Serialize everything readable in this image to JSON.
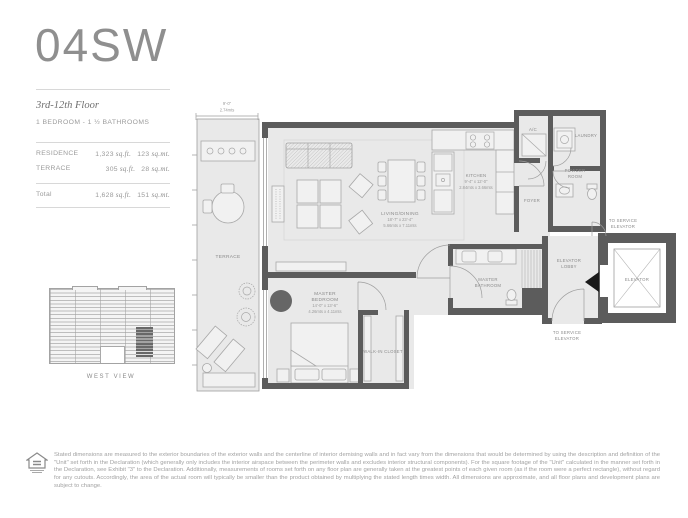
{
  "header": {
    "unit_title": "04SW",
    "floor_range": "3rd-12th Floor",
    "configuration": "1 BEDROOM - 1 ½ BATHROOMS",
    "area_rows": [
      {
        "label": "RESIDENCE",
        "sqft_value": "1,323",
        "sqft_unit": "sq.ft.",
        "sqmt_value": "123",
        "sqmt_unit": "sq.mt."
      },
      {
        "label": "TERRACE",
        "sqft_value": "305",
        "sqft_unit": "sq.ft.",
        "sqmt_value": "28",
        "sqmt_unit": "sq.mt."
      }
    ],
    "total_row": {
      "label": "Total",
      "sqft_value": "1,628",
      "sqft_unit": "sq.ft.",
      "sqmt_value": "151",
      "sqmt_unit": "sq.mt."
    }
  },
  "elevation": {
    "caption": "WEST VIEW"
  },
  "plan": {
    "terrace_dim": {
      "ft": "9'-0\"",
      "m": "2.74mts"
    },
    "labels": {
      "terrace": "TERRACE",
      "living_name": "LIVING/DINING",
      "living_ft": "18'-7\" x 23'-4\"",
      "living_m": "5.66mts x 7.11mts",
      "kitchen_name": "KITCHEN",
      "kitchen_ft": "9'-4\" x 12'-0\"",
      "kitchen_m": "2.84mts x 3.66mts",
      "bedroom_1": "MASTER",
      "bedroom_2": "BEDROOM",
      "bedroom_ft": "14'-0\" x 13'-6\"",
      "bedroom_m": "4.26mts x 4.11mts",
      "bathroom_1": "MASTER",
      "bathroom_2": "BATHROOM",
      "closet": "WALK-IN CLOSET",
      "foyer": "FOYER",
      "ac": "A/C",
      "laundry": "LAUNDRY",
      "powder_1": "POWDER",
      "powder_2": "ROOM",
      "lobby_1": "ELEVATOR",
      "lobby_2": "LOBBY",
      "elevator": "ELEVATOR",
      "service_top_1": "TO SERVICE",
      "service_top_2": "ELEVATOR",
      "service_bottom_1": "TO SERVICE",
      "service_bottom_2": "ELEVATOR"
    }
  },
  "disclaimer": {
    "text": "Stated dimensions are measured to the exterior boundaries of the exterior walls and the centerline of interior demising walls and in fact vary from the dimensions that would be determined by using the description and definition of the \"Unit\" set forth in the Declaration (which generally only includes the interior airspace between the perimeter walls and excludes interior structural components).  For the square footage of the \"Unit\" calculated in the manner set forth in the Declaration, see Exhibit \"3\" to the Declaration.  Additionally, measurements of rooms set forth on any floor plan are generally taken at the greatest points of each given room (as if the room were a perfect rectangle), without regard for any cutouts.  Accordingly, the area of the actual room will typically be smaller than the product obtained by multiplying the stated length times width.  All dimensions are approximate, and all floor plans and development plans are subject to change."
  },
  "colors": {
    "wall": "#5c5c5c",
    "floor": "#e9e9e9",
    "label": "#8a8a8a",
    "elevator_arrow": "#1a1a1a",
    "unit_highlight": "#686868"
  }
}
